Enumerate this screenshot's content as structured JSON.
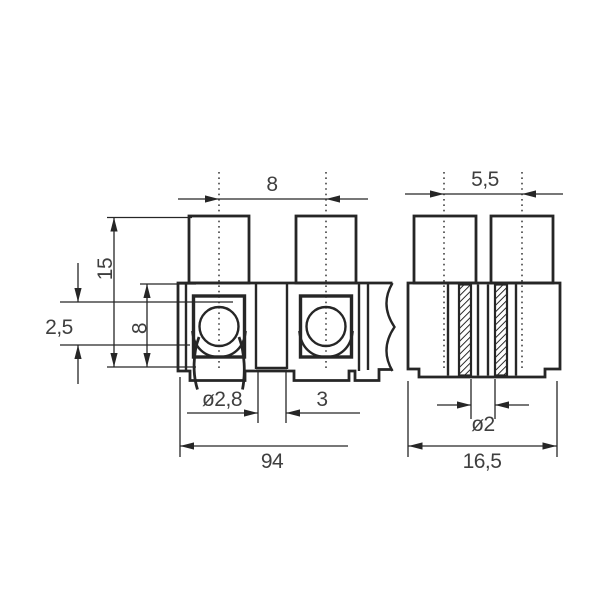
{
  "front_view": {
    "pitch": "8",
    "total_height": "15",
    "body_height": "8",
    "clamp_depth": "2,5",
    "wire_hole_diameter": "ø2,8",
    "hole_offset": "3",
    "length": "94"
  },
  "side_view": {
    "screw_spacing": "5,5",
    "screw_hole_diameter": "ø2",
    "width": "16,5"
  }
}
